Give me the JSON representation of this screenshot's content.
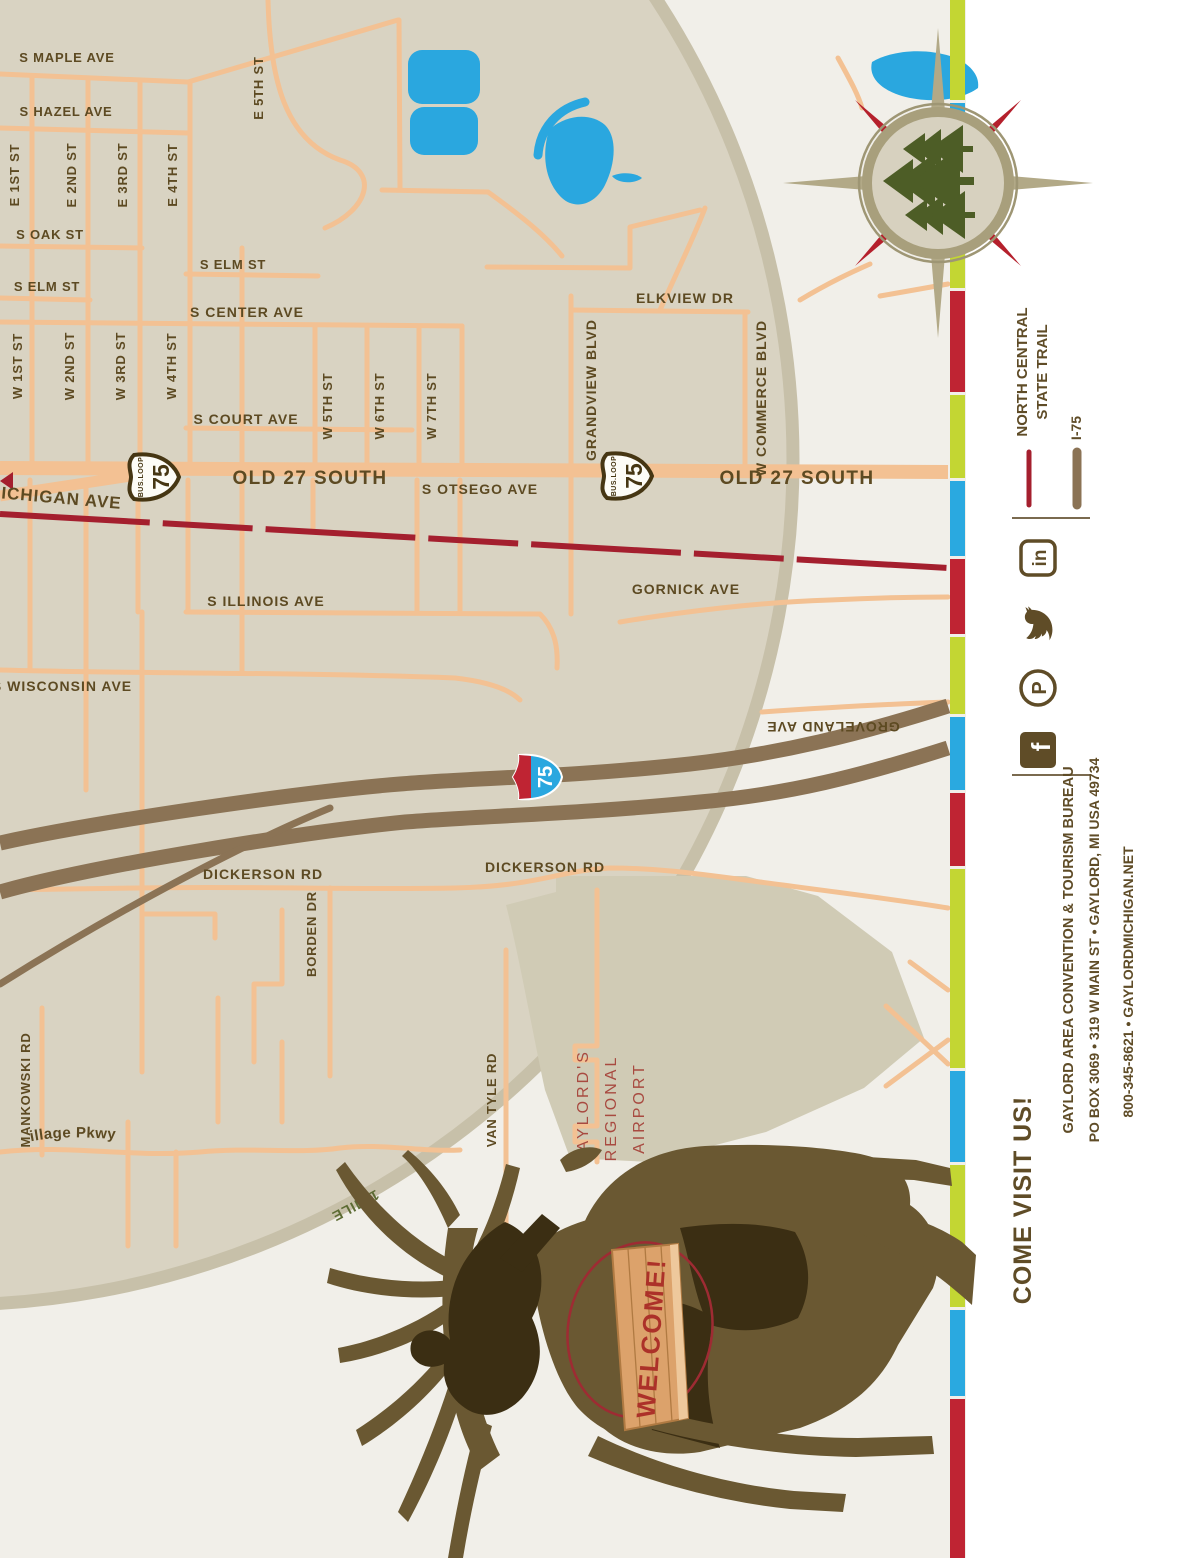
{
  "map": {
    "labels": {
      "s_maple": "S MAPLE AVE",
      "s_hazel": "S HAZEL AVE",
      "s_oak": "S OAK ST",
      "s_elm_e": "S ELM ST",
      "s_elm_w": "S ELM ST",
      "s_center": "S CENTER AVE",
      "s_court": "S COURT AVE",
      "michigan": "MICHIGAN AVE",
      "old27_w": "OLD 27 SOUTH",
      "old27_e": "OLD 27 SOUTH",
      "s_otsego": "S OTSEGO AVE",
      "elkview": "ELKVIEW DR",
      "gornick": "GORNICK AVE",
      "s_illinois": "S ILLINOIS AVE",
      "s_wisconsin": "S WISCONSIN AVE",
      "dickerson_w": "DICKERSON RD",
      "dickerson_e": "DICKERSON RD",
      "groveland": "GROVELAND AVE",
      "borden": "BORDEN DR",
      "mankowski": "MANKOWSKI RD",
      "van_tyle": "VAN TYLE RD",
      "edelweiss": "Edelweiss Village Pkwy",
      "one_mile": "1 MILE",
      "e1": "E 1ST ST",
      "e2": "E 2ND ST",
      "e3": "E 3RD ST",
      "e4": "E 4TH ST",
      "e5": "E 5TH ST",
      "w1": "W 1ST ST",
      "w2": "W 2ND ST",
      "w3": "W 3RD ST",
      "w4": "W 4TH ST",
      "w5": "W 5TH ST",
      "w6": "W 6TH ST",
      "w7": "W 7TH ST",
      "grandview": "GRANDVIEW BLVD",
      "commerce": "W COMMERCE BLVD",
      "airport_1": "GAYLORD'S",
      "airport_2": "REGIONAL",
      "airport_3": "AIRPORT"
    },
    "shields": {
      "bus_loop_top": "BUS.LOOP",
      "bus_loop_number": "75",
      "interstate_number": "75"
    },
    "elk_sign": "WELCOME!"
  },
  "legend": {
    "trail_line1": "NORTH CENTRAL",
    "trail_line2": "STATE TRAIL",
    "i75": "I-75"
  },
  "social": {
    "linkedin_glyph": "in",
    "pinterest_glyph": "P",
    "facebook_glyph": "f"
  },
  "contact": {
    "come_visit": "COME VISIT US!",
    "org": "GAYLORD AREA CONVENTION & TOURISM BUREAU",
    "address": "PO BOX 3069 • 319 W MAIN ST • GAYLORD, MI USA 49734",
    "phone_web": "800-345-8621  •  GAYLORDMICHIGAN.NET"
  },
  "colors": {
    "street": "#f3c193",
    "trail_red": "#a41f2e",
    "highway_brown": "#8b7355",
    "lake_blue": "#2aa7df",
    "stripe_lime": "#c3d633",
    "stripe_blue": "#2aa9e0",
    "stripe_red": "#bf2433",
    "label_brown": "#5d4a22",
    "circle_fill": "#d9d3c2",
    "outside_fill": "#f1efe9",
    "airport_text": "#a84a40",
    "elk_body": "#6a5832",
    "elk_dark": "#3b2e13"
  }
}
